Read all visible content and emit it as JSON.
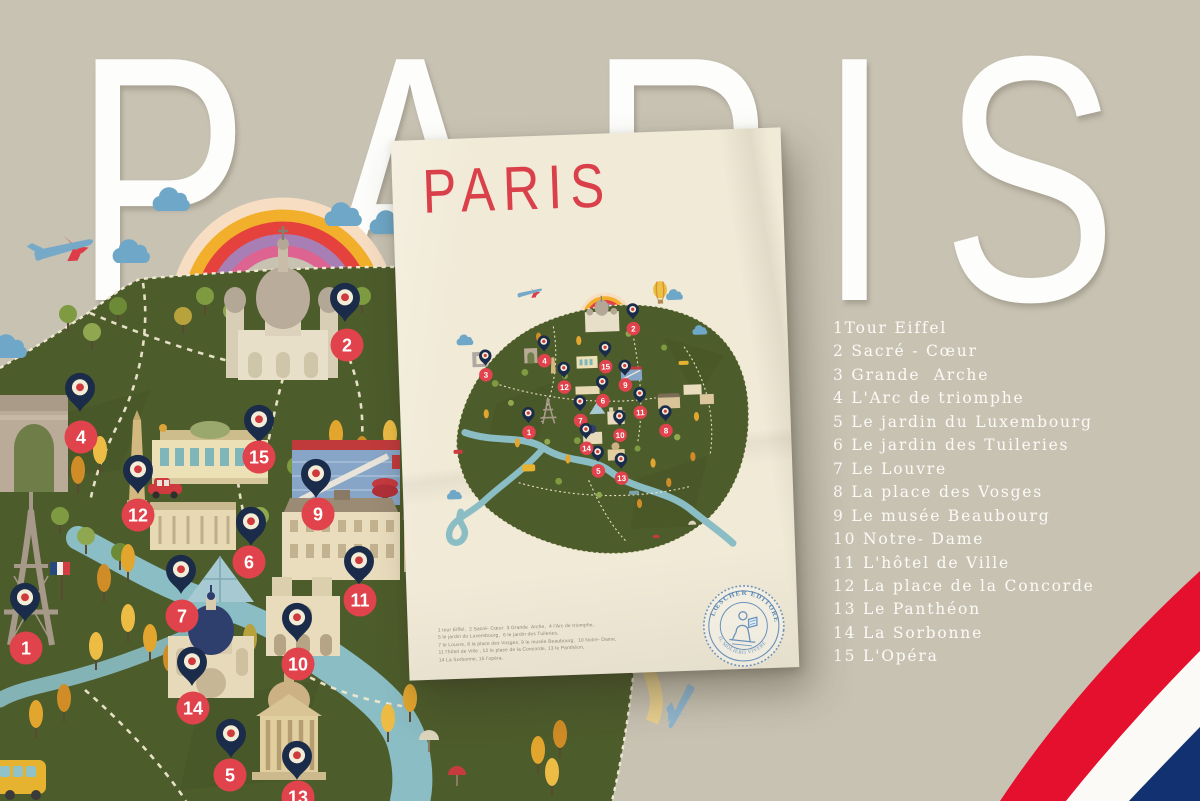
{
  "page": {
    "bg_color": "#c8c2b3"
  },
  "background": {
    "title": "PARIS",
    "letters": [
      "P",
      "A",
      "R",
      "I",
      "S"
    ]
  },
  "poster": {
    "title": "PARIS",
    "legend_lines": [
      "1 tour Eiffel,  2 Sacré- Cœur  3 Grande  Arche,  4 l'Arc de triomphe,",
      "5 le jardin du Luxembourg,  6 le jardin des Tuileries,",
      "7 le Louvre, 8 la place des Vosges, 9 le musée Beaubourg,  10 Notre- Dame,",
      "11 l'hôtel de Ville , 12 le place de la Concorde, 13 le Panthéon,",
      "14 La Sorbonne, 15 l'opéra."
    ],
    "stamp": {
      "text_top": "LŒSCHER EDITORE",
      "text_bottom": "IL MOLIERO VIVERE"
    },
    "map": {
      "markers": [
        {
          "n": "1",
          "x": 92,
          "y": 150
        },
        {
          "n": "2",
          "x": 200,
          "y": 50
        },
        {
          "n": "3",
          "x": 51,
          "y": 91
        },
        {
          "n": "4",
          "x": 110,
          "y": 79
        },
        {
          "n": "5",
          "x": 160,
          "y": 191
        },
        {
          "n": "6",
          "x": 167,
          "y": 121
        },
        {
          "n": "7",
          "x": 144,
          "y": 140
        },
        {
          "n": "8",
          "x": 229,
          "y": 153
        },
        {
          "n": "9",
          "x": 190,
          "y": 106
        },
        {
          "n": "10",
          "x": 183,
          "y": 156
        },
        {
          "n": "11",
          "x": 204,
          "y": 134
        },
        {
          "n": "12",
          "x": 129,
          "y": 106
        },
        {
          "n": "13",
          "x": 183,
          "y": 199
        },
        {
          "n": "14",
          "x": 149,
          "y": 168
        },
        {
          "n": "15",
          "x": 171,
          "y": 87
        }
      ]
    }
  },
  "legend": {
    "items": [
      "1Tour Eiffel",
      "2 Sacré - Cœur",
      "3 Grande  Arche",
      "4 L'Arc de triomphe",
      "5 Le jardin du Luxembourg",
      "6 Le jardin des Tuileries",
      "7 Le Louvre",
      "8 La place des Vosges",
      "9 Le musée Beaubourg",
      "10 Notre- Dame",
      "11 L'hôtel de Ville",
      "12 La place de la Concorde",
      "13 Le Panthéon",
      "14 La Sorbonne",
      "15 L'Opéra"
    ]
  },
  "big_map": {
    "markers": [
      {
        "n": "1",
        "px": 25,
        "py": 622,
        "bx": 26,
        "by": 648
      },
      {
        "n": "2",
        "px": 345,
        "py": 322,
        "bx": 347,
        "by": 345
      },
      {
        "n": "4",
        "px": 80,
        "py": 412,
        "bx": 81,
        "by": 437
      },
      {
        "n": "5",
        "px": 231,
        "py": 758,
        "bx": 230,
        "by": 775
      },
      {
        "n": "6",
        "px": 251,
        "py": 546,
        "bx": 249,
        "by": 562
      },
      {
        "n": "7",
        "px": 181,
        "py": 594,
        "bx": 182,
        "by": 616
      },
      {
        "n": "9",
        "px": 316,
        "py": 498,
        "bx": 318,
        "by": 514
      },
      {
        "n": "10",
        "px": 297,
        "py": 642,
        "bx": 298,
        "by": 664
      },
      {
        "n": "11",
        "px": 359,
        "py": 585,
        "bx": 360,
        "by": 600
      },
      {
        "n": "12",
        "px": 138,
        "py": 494,
        "bx": 138,
        "by": 515
      },
      {
        "n": "13",
        "px": 297,
        "py": 780,
        "bx": 298,
        "by": 797
      },
      {
        "n": "14",
        "px": 192,
        "py": 686,
        "bx": 193,
        "by": 708
      },
      {
        "n": "15",
        "px": 259,
        "py": 444,
        "bx": 259,
        "by": 457
      }
    ]
  },
  "colors": {
    "background": "#c8c2b3",
    "map_green": "#4d5c2b",
    "river": "#8bbdc5",
    "path_dash": "#efe8cf",
    "pin_navy": "#1b2b4a",
    "pin_ring": "#f3ecd7",
    "pin_center": "#cf3a3e",
    "badge_red": "#e0434b",
    "badge_text": "#ffffff",
    "letters_white": "#fdfdfb",
    "poster_paper": "#f1ead7",
    "poster_title_red": "#d9404a",
    "stamp_blue": "#6a92ba",
    "flag_red": "#e50f2e",
    "flag_white": "#fbfaf6",
    "flag_blue": "#123170",
    "rainbow": [
      "#f7ddc2",
      "#f2af2b",
      "#e5423e",
      "#a77fb5",
      "#dd6390"
    ]
  }
}
